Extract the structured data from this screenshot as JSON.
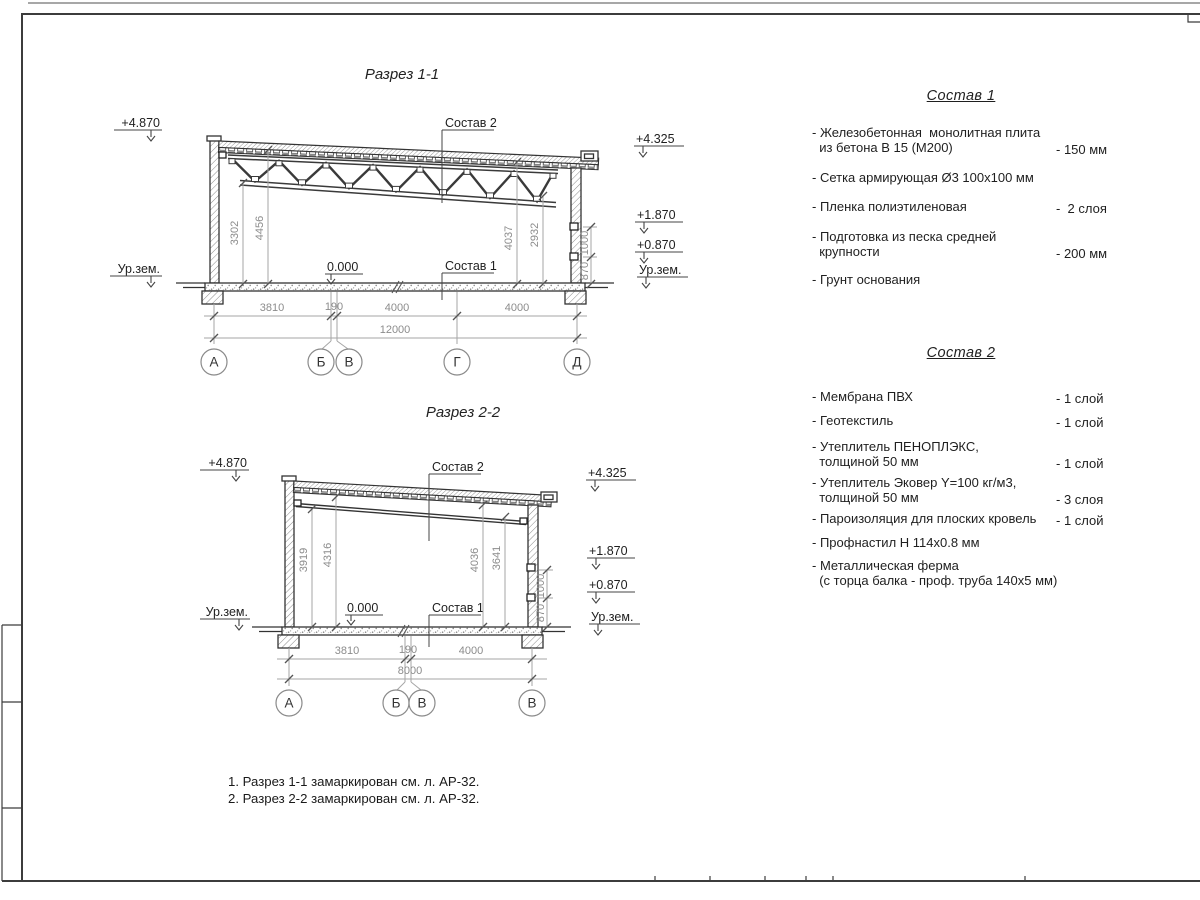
{
  "page": {
    "bg": "#ffffff",
    "line_color": "#3c3c3c",
    "dim_color": "#8c8c8c"
  },
  "s1": {
    "title": "Разрез 1-1",
    "elev_tl": "+4.870",
    "elev_tr": "+4.325",
    "elev_r1": "+1.870",
    "elev_r2": "+0.870",
    "ground_l": "Ур.зем.",
    "ground_r": "Ур.зем.",
    "zero": "0.000",
    "sostav2": "Состав 2",
    "sostav1": "Состав 1",
    "vd1": "3302",
    "vd2": "4456",
    "vd3": "4037",
    "vd4": "2932",
    "vd5": "870",
    "vd6": "1000",
    "hd1": "3810",
    "hd2": "190",
    "hd3": "4000",
    "hd4": "4000",
    "hdt": "12000",
    "g1": "А",
    "g2": "Б",
    "g3": "В",
    "g4": "Г",
    "g5": "Д"
  },
  "s2": {
    "title": "Разрез 2-2",
    "elev_tl": "+4.870",
    "elev_tr": "+4.325",
    "elev_r1": "+1.870",
    "elev_r2": "+0.870",
    "ground_l": "Ур.зем.",
    "ground_r": "Ур.зем.",
    "zero": "0.000",
    "sostav2": "Состав 2",
    "sostav1": "Состав 1",
    "vd1": "3919",
    "vd2": "4316",
    "vd3": "4036",
    "vd4": "3641",
    "vd5": "870",
    "vd6": "1000",
    "hd1": "3810",
    "hd2": "190",
    "hd3": "4000",
    "hdt": "8000",
    "g1": "А",
    "g2": "Б",
    "g3": "В",
    "g4": "В"
  },
  "comp1": {
    "title": "Состав 1",
    "items": [
      {
        "name": "- Железобетонная  монолитная плита\n  из бетона В 15 (М200)",
        "value": "- 150 мм"
      },
      {
        "name": "- Сетка армирующая Ø3 100x100 мм",
        "value": ""
      },
      {
        "name": "- Пленка полиэтиленовая",
        "value": "-  2 слоя"
      },
      {
        "name": "- Подготовка из песка средней\n  крупности",
        "value": "- 200 мм"
      },
      {
        "name": "- Грунт основания",
        "value": ""
      }
    ]
  },
  "comp2": {
    "title": "Состав 2",
    "items": [
      {
        "name": "- Мембрана ПВХ",
        "value": "- 1 слой"
      },
      {
        "name": "- Геотекстиль",
        "value": "- 1 слой"
      },
      {
        "name": "- Утеплитель ПЕНОПЛЭКС,\n  толщиной 50 мм",
        "value": "- 1 слой"
      },
      {
        "name": "- Утеплитель Эковер Y=100 кг/м3,\n  толщиной 50 мм",
        "value": "- 3 слоя"
      },
      {
        "name": "- Пароизоляция для плоских кровель",
        "value": "- 1 слой"
      },
      {
        "name": "- Профнастил Н 114x0.8 мм",
        "value": ""
      },
      {
        "name": "- Металлическая ферма\n  (с торца балка - проф. труба 140x5 мм)",
        "value": ""
      }
    ]
  },
  "notes": {
    "n1": "1. Разрез 1-1 замаркирован см. л. АР-32.",
    "n2": "2. Разрез 2-2 замаркирован см. л. АР-32."
  }
}
